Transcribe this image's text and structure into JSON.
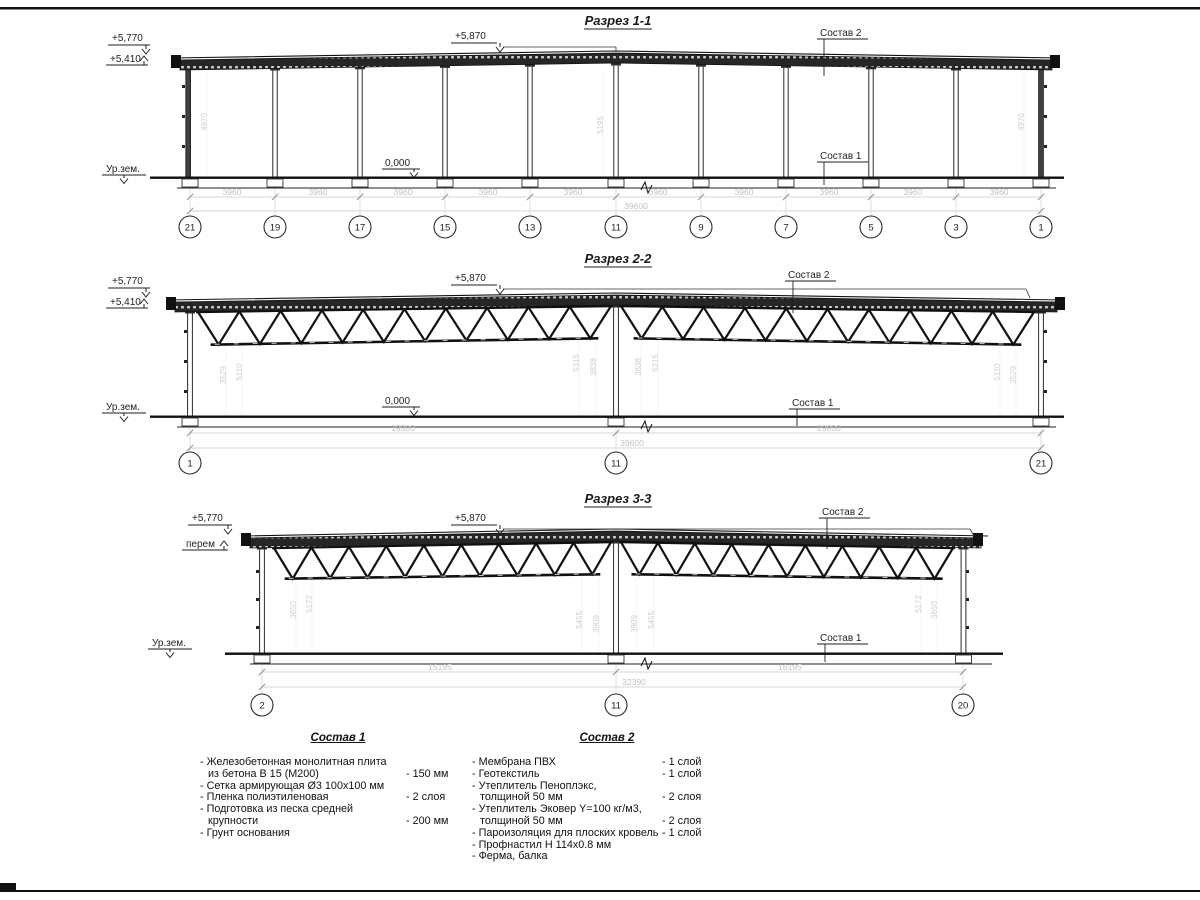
{
  "sections": [
    {
      "title": "Разрез 1-1",
      "elev_parapet": "+5,770",
      "elev_eave": "+5,410",
      "elev_ridge": "+5,870",
      "elev_floor": "0,000",
      "ground": "Ур.зем.",
      "leader_roof": "Состав 2",
      "leader_floor": "Состав 1",
      "span_dims": [
        "3960",
        "3960",
        "3960",
        "3960",
        "3960",
        "3960",
        "3960",
        "3960",
        "3960",
        "3960"
      ],
      "total_dim": "39600",
      "grids": [
        "21",
        "19",
        "17",
        "15",
        "13",
        "11",
        "9",
        "7",
        "5",
        "3",
        "1"
      ],
      "height_dims": [
        "4970",
        "5195",
        "4970"
      ]
    },
    {
      "title": "Разрез 2-2",
      "elev_parapet": "+5,770",
      "elev_eave": "+5,410",
      "elev_ridge": "+5,870",
      "elev_floor": "0,000",
      "ground": "Ур.зем.",
      "leader_roof": "Состав 2",
      "leader_floor": "Состав 1",
      "span_dims": [
        "19800",
        "19800"
      ],
      "total_dim": "39600",
      "grids": [
        "1",
        "11",
        "21"
      ],
      "height_dims": [
        "3529",
        "5110",
        "5315",
        "3838",
        "3838",
        "5315",
        "5110",
        "3529"
      ]
    },
    {
      "title": "Разрез 3-3",
      "elev_parapet": "+5,770",
      "elev_eave": "перем",
      "elev_ridge": "+5,870",
      "ground": "Ур.зем.",
      "leader_roof": "Состав 2",
      "leader_floor": "Состав 1",
      "span_dims": [
        "16195",
        "16195"
      ],
      "total_dim": "32390",
      "grids": [
        "2",
        "11",
        "20"
      ],
      "height_dims": [
        "3650",
        "5172",
        "5455",
        "3909",
        "3909",
        "5455",
        "5172",
        "3650"
      ]
    }
  ],
  "compositions": [
    {
      "title": "Состав 1",
      "rows": [
        {
          "text": "- Железобетонная  монолитная плита",
          "value": ""
        },
        {
          "text": "из бетона В 15 (М200)",
          "value": "- 150 мм"
        },
        {
          "text": "- Сетка армирующая Ø3 100х100 мм",
          "value": ""
        },
        {
          "text": "- Пленка полиэтиленовая",
          "value": "-  2 слоя"
        },
        {
          "text": "- Подготовка из песка средней",
          "value": ""
        },
        {
          "text": "крупности",
          "value": "- 200 мм"
        },
        {
          "text": "- Грунт основания",
          "value": ""
        }
      ]
    },
    {
      "title": "Состав 2",
      "rows": [
        {
          "text": "- Мембрана ПВХ",
          "value": "- 1 слой"
        },
        {
          "text": "- Геотекстиль",
          "value": "- 1 слой"
        },
        {
          "text": "- Утеплитель Пеноплэкс,",
          "value": ""
        },
        {
          "text": "толщиной 50 мм",
          "value": "- 2 слоя"
        },
        {
          "text": "- Утеплитель Эковер Y=100 кг/м3,",
          "value": ""
        },
        {
          "text": "толщиной 50 мм",
          "value": "- 2 слоя"
        },
        {
          "text": "- Пароизоляция для плоских кровель",
          "value": "- 1 слой"
        },
        {
          "text": "- Профнастил Н 114х0.8 мм",
          "value": ""
        },
        {
          "text": "- Ферма, балка",
          "value": ""
        }
      ]
    }
  ]
}
